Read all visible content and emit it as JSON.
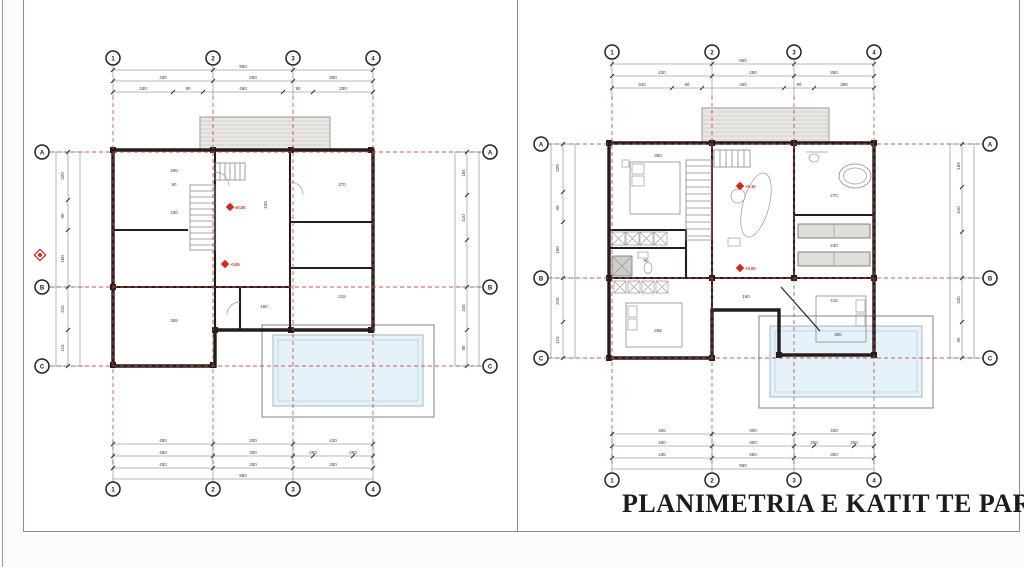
{
  "sheet": {
    "background": "#fcfbf9",
    "panel_border": "#8c8c8c"
  },
  "colors": {
    "wall": "#241d1b",
    "grid_red": "#c4483f",
    "level_red": "#d42a1e",
    "pool_fill": "#e6f2fa",
    "pool_border": "#9fb8c6",
    "terrace_fill": "#eae8e4",
    "dim_text": "#3a3a3a"
  },
  "plans": [
    {
      "grid_cols": [
        "1",
        "2",
        "3",
        "4"
      ],
      "grid_rows": [
        "A",
        "B",
        "C"
      ],
      "dims": {
        "top_total": "950",
        "top_spans": [
          "430",
          "250",
          "350"
        ],
        "top_subs": [
          "340",
          "90",
          "460",
          "90",
          "280"
        ],
        "bottom_r1": [
          "450",
          "300",
          "430"
        ],
        "bottom_r2": [
          "450",
          "300",
          "250",
          "250"
        ],
        "bottom_r3": [
          "430",
          "350",
          "350"
        ],
        "bottom_total": "950",
        "left": [
          "320",
          "90",
          "160",
          "315",
          "115"
        ],
        "right": [
          "165",
          "410",
          "345",
          "90"
        ]
      },
      "levels": [
        "±0.00",
        "-0.05"
      ],
      "interior_dims": [
        "260",
        "90",
        "230",
        "420",
        "270",
        "365",
        "160",
        "315"
      ]
    },
    {
      "caption": "PLANIMETRIA E KATIT TE PARE",
      "grid_cols": [
        "1",
        "2",
        "3",
        "4"
      ],
      "grid_rows": [
        "A",
        "B",
        "C"
      ],
      "dims": {
        "top_total": "950",
        "top_spans": [
          "430",
          "250",
          "350"
        ],
        "top_subs": [
          "340",
          "90",
          "460",
          "90",
          "280"
        ],
        "bottom_r1": [
          "450",
          "300",
          "430"
        ],
        "bottom_r2": [
          "450",
          "300",
          "250",
          "250"
        ],
        "bottom_r3": [
          "430",
          "350",
          "350"
        ],
        "bottom_total": "950",
        "left": [
          "320",
          "90",
          "160",
          "315",
          "115"
        ],
        "right": [
          "165",
          "410",
          "345",
          "90"
        ]
      },
      "levels": [
        "+3.10",
        "+3.00"
      ],
      "interior_dims": [
        "350",
        "270",
        "230",
        "265",
        "160",
        "300",
        "90",
        "415"
      ]
    }
  ]
}
